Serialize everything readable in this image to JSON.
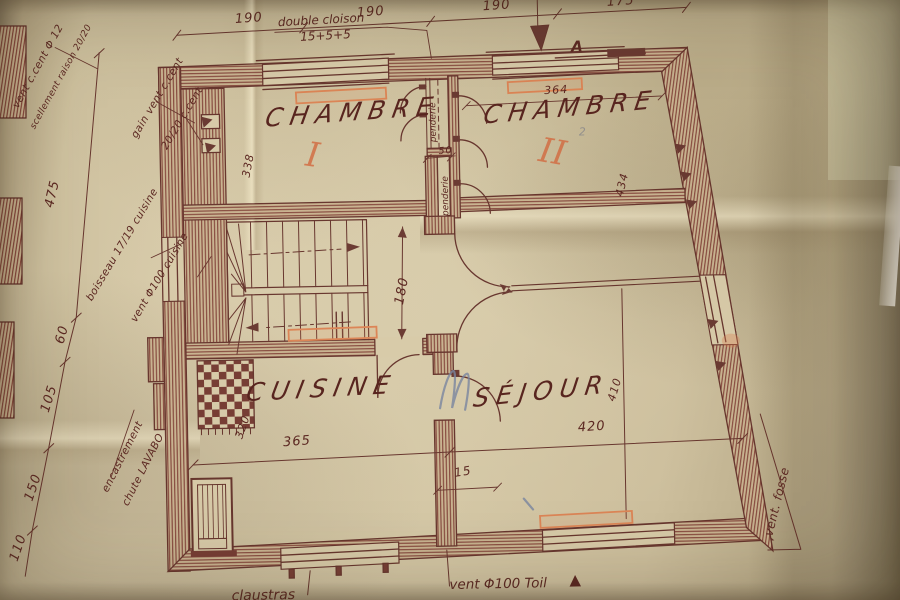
{
  "plan": {
    "rooms": {
      "chambre1": {
        "label": "CHAMBRE",
        "numeral": "I"
      },
      "chambre2": {
        "label": "CHAMBRE",
        "numeral": "II",
        "pencil_note": "2"
      },
      "cuisine": {
        "label": "CUISINE"
      },
      "sejour": {
        "label": "SÉJOUR"
      },
      "penderie": {
        "label_upper": "penderie",
        "label_lower": "penderie"
      }
    },
    "dims": {
      "top": [
        "190",
        "190",
        "190",
        "175"
      ],
      "left": [
        "475",
        "60",
        "105",
        "150",
        "110"
      ],
      "chambre1_depth": "338",
      "chambre2_width": "364",
      "chambre2_depth": "434",
      "penderie": "50",
      "hall": "180",
      "cuisine_depth": "320",
      "cuisine_width": "365",
      "partition": "15",
      "sejour_depth": "410",
      "sejour_width": "420"
    },
    "notes": {
      "double_cloison": "double cloison",
      "double_cloison_size": "15+5+5",
      "section_letter": "A",
      "vent_ccent": "vent c.cent Φ 12",
      "scellement": "scellement raison 20/20",
      "gaine_vent": "gain vent c.cent",
      "ccent_size": "20/20 c.cent",
      "boisseau": "boisseau 17/19 cuisine",
      "vent_cuisine": "vent Φ100 cuisine",
      "encastrement": "encastrement",
      "chute_lavabo": "chute LAVABO",
      "vent_fosse": "vent. fosse",
      "claustras": "claustras",
      "vent_toil": "vent Φ100 Toil",
      "toil_arrow": "▲"
    },
    "colors": {
      "ink": "#63302a",
      "orange": "#dd8050",
      "blue_pencil": "#72809f",
      "paper": "#d2c5a3"
    }
  }
}
